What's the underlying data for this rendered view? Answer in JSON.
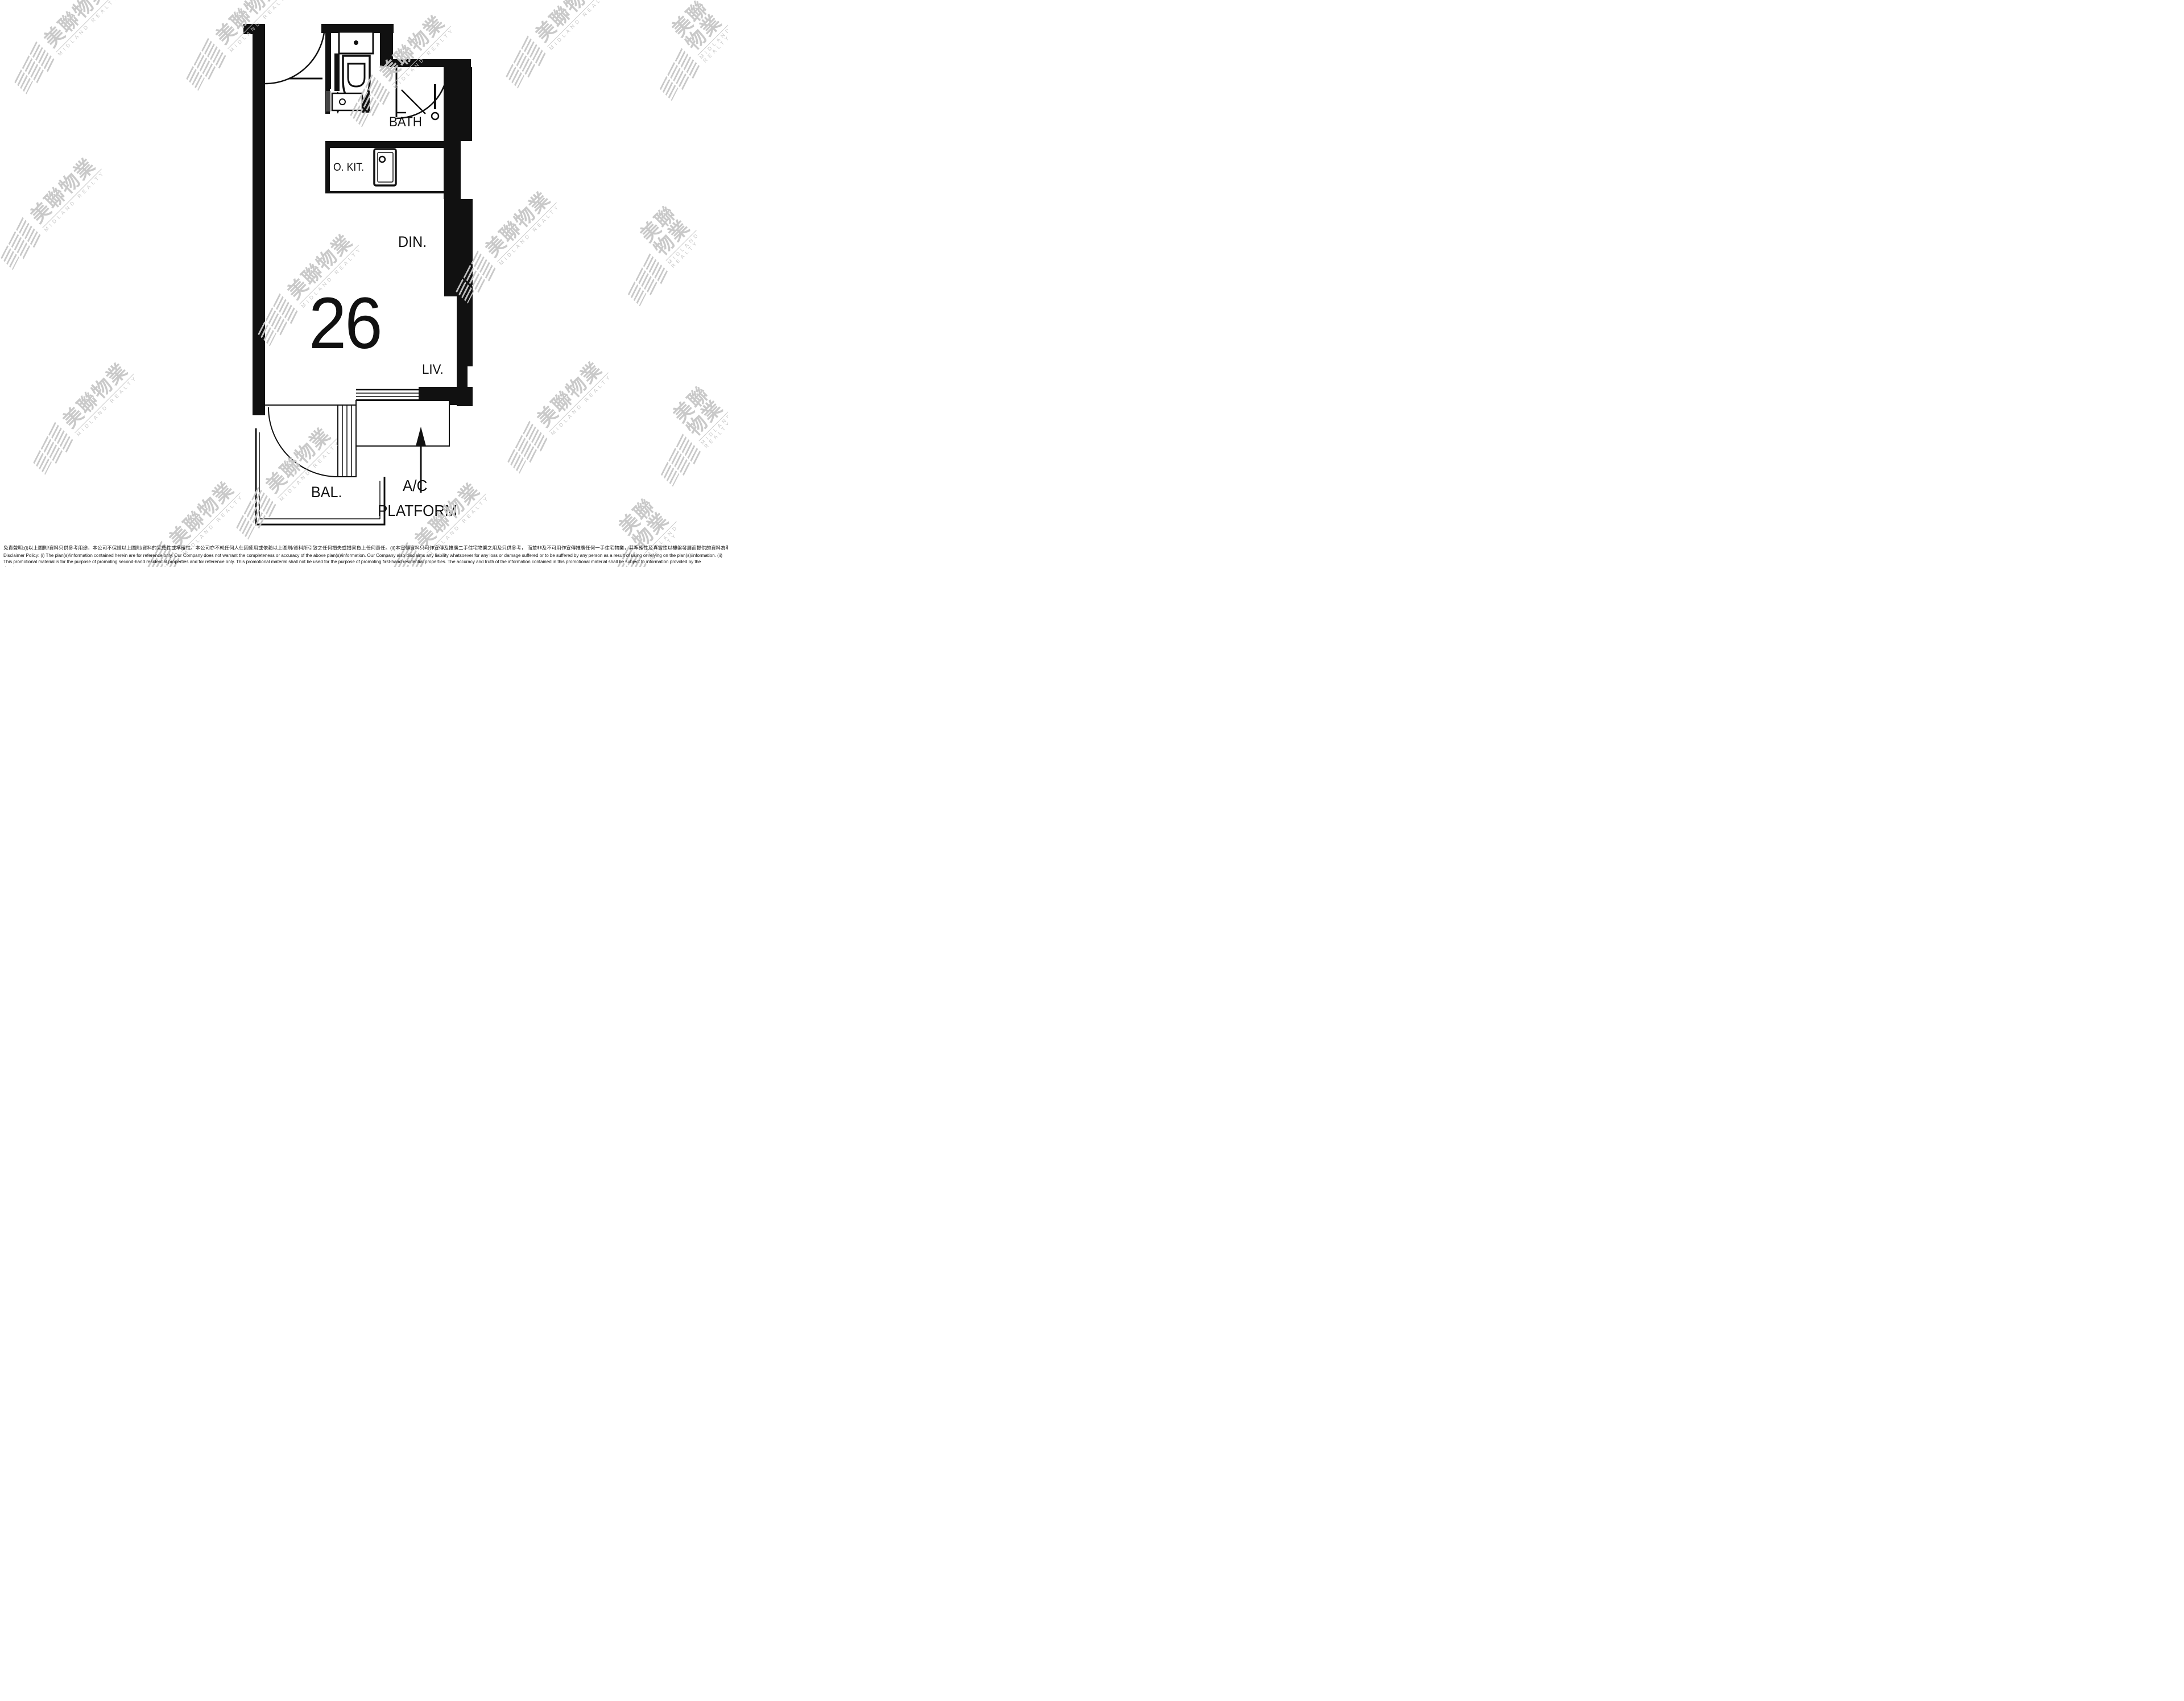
{
  "plan": {
    "unit_number": "26",
    "labels": {
      "bath": "BATH",
      "open_kitchen": "O. KIT.",
      "dining": "DIN.",
      "living": "LIV.",
      "balcony": "BAL.",
      "ac_line1": "A/C",
      "ac_line2": "PLATFORM"
    }
  },
  "watermark": {
    "cn": "美聯物業",
    "en": "MIDLAND REALTY"
  },
  "disclaimer": {
    "zh": "免責聲明:(i)以上圖則/資料只供參考用途，本公司不保證以上圖則/資料的完整性或準確性。本公司亦不就任何人仕因使用或依賴以上圖則/資料所引致之任何損失或損害負上任何責任。(ii)本宣傳資料只可作宣傳及推廣二手住宅物業之用及只供參考， 而並非及不可用作宣傳推廣任何一手住宅物業，其準確性及真實性以樓盤發展商提供的資料為準。",
    "en": "Disclaimer Policy: (i) The plan(s)/information contained herein are for reference only. Our Company does not warrant the completeness or accuracy of the above plan(s)/information. Our Company also disclaims any liability whatsoever for any loss or damage suffered or to be suffered by any person as a result of using or relying on the plan(s)/information. (ii) This promotional material is for the purpose of promoting second-hand residential properties and for reference only. This promotional material shall not be used for the purpose of promoting first-hand residential properties. The accuracy and truth of the information contained in this promotional material shall be subject to information provided by the developers."
  },
  "colors": {
    "wall": "#111111",
    "watermark": "#c7c7c7",
    "background": "#ffffff"
  }
}
